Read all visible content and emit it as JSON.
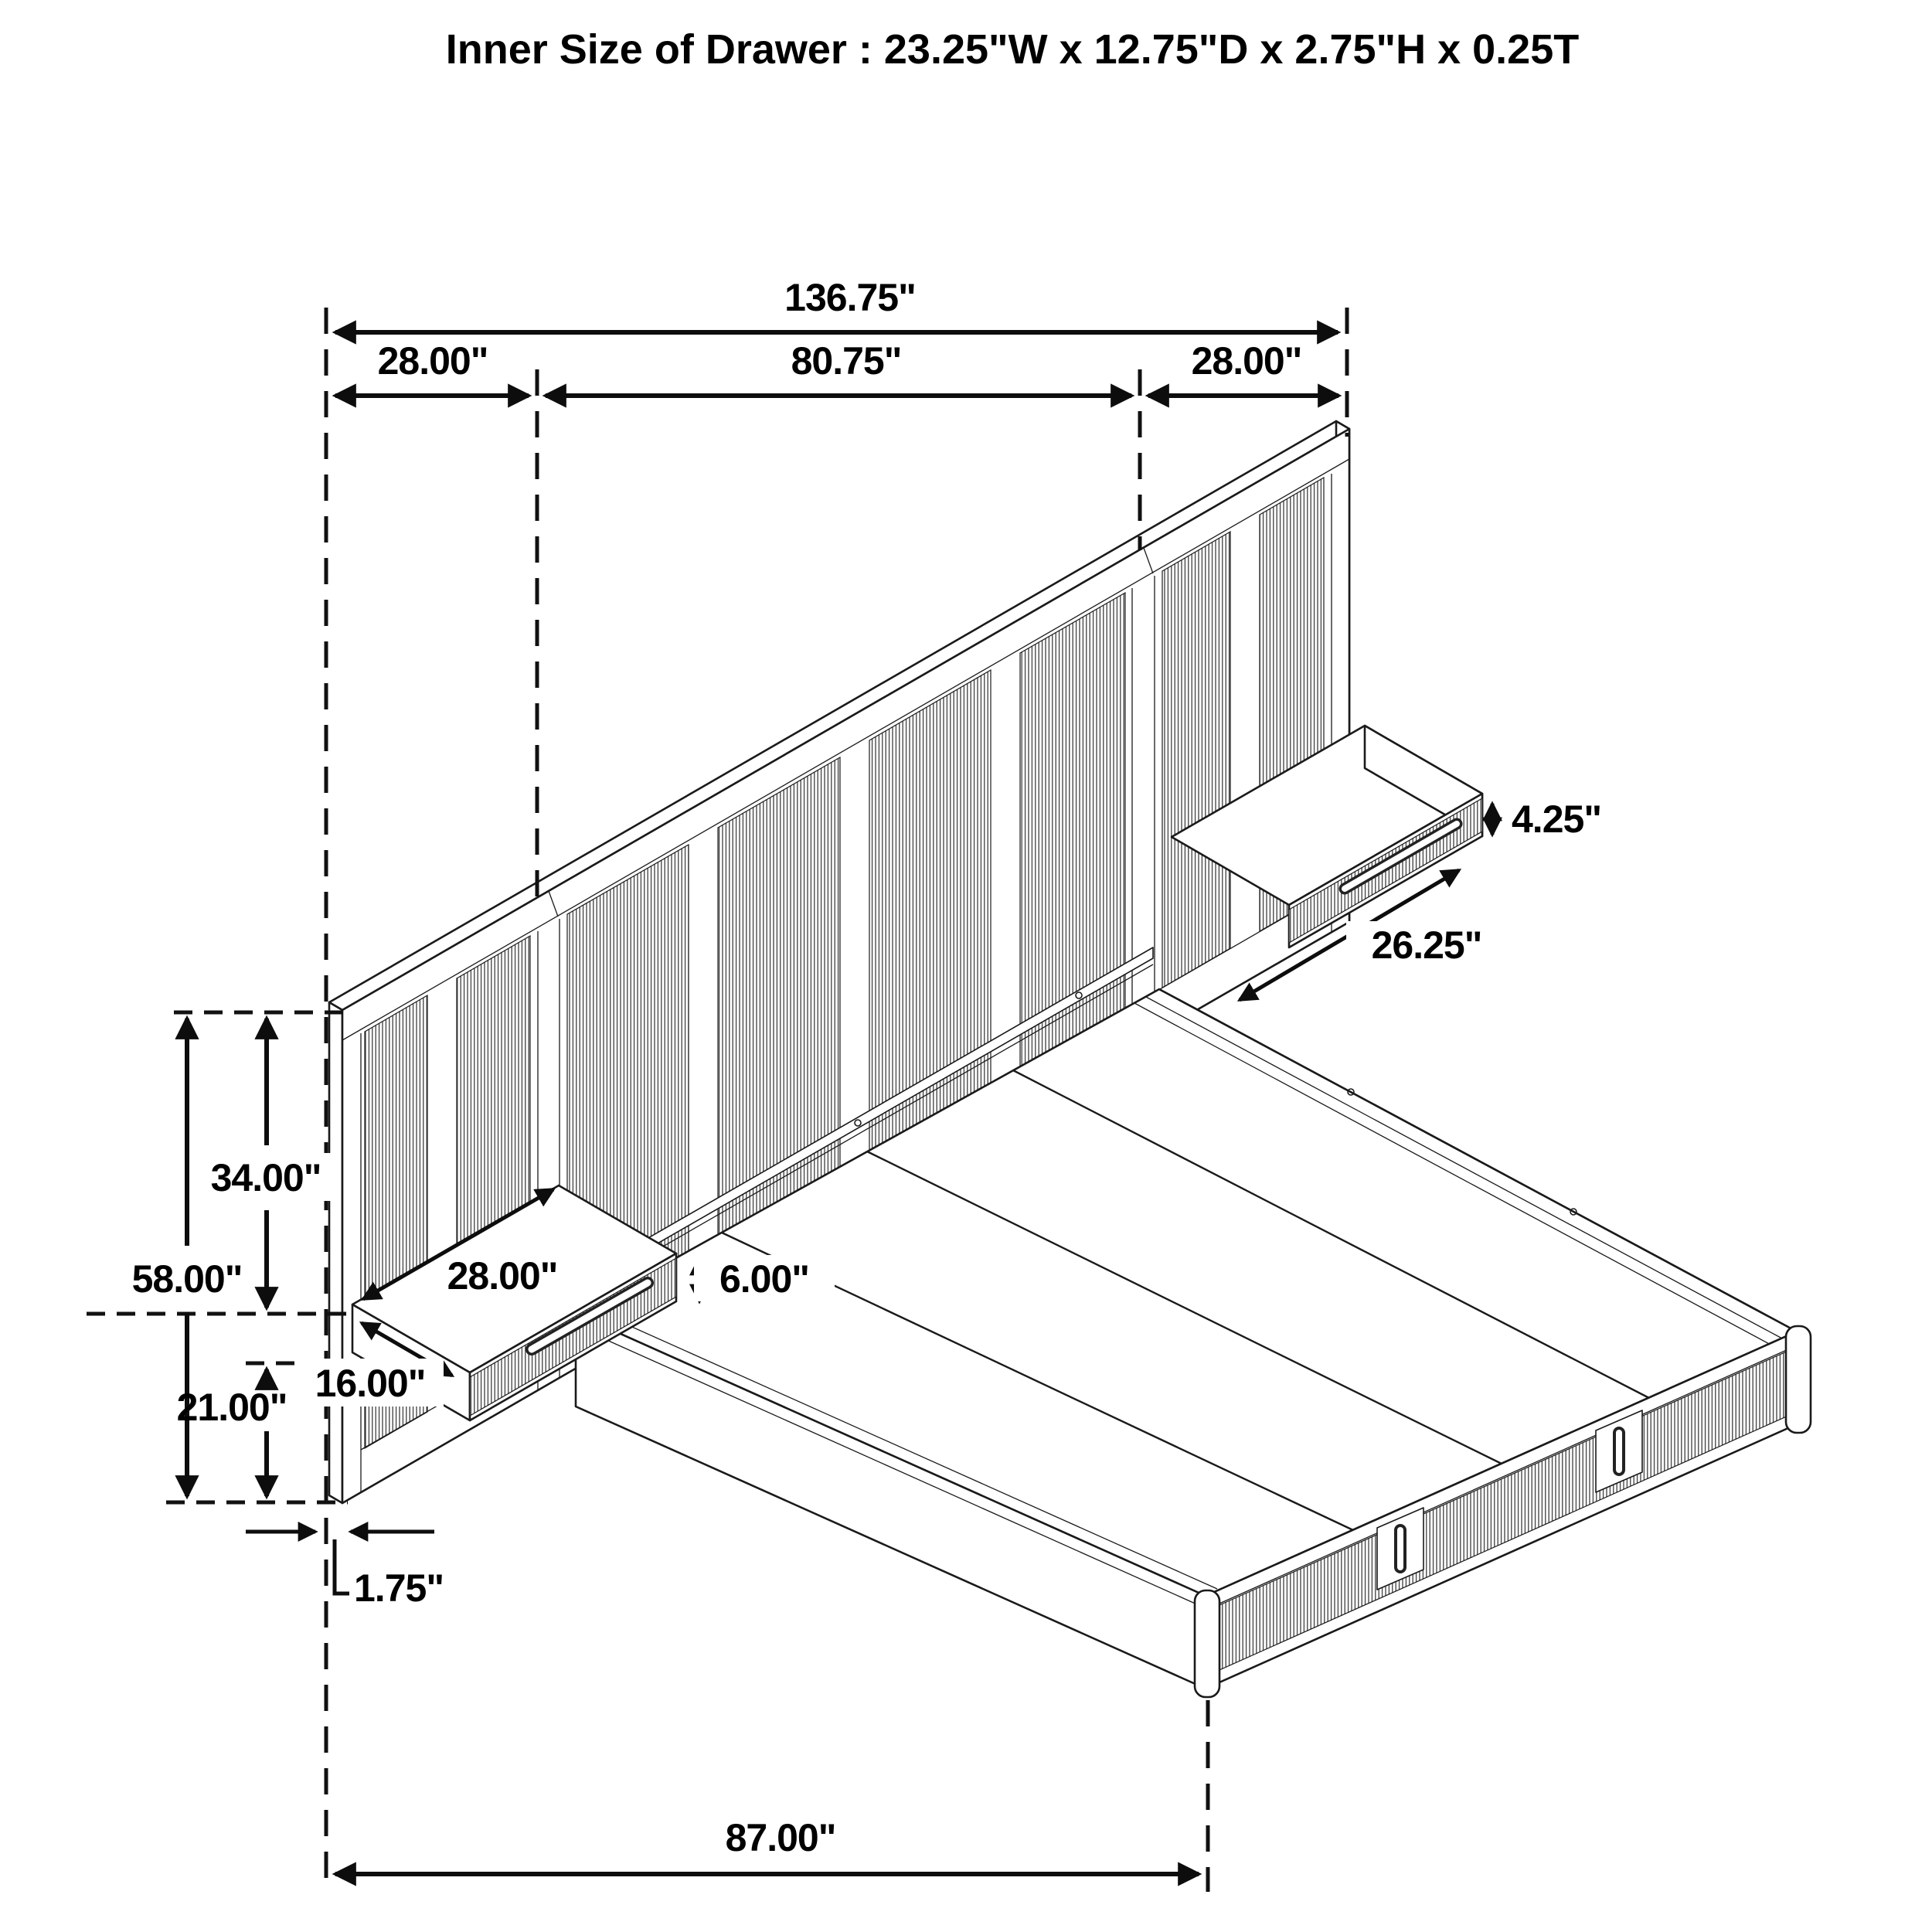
{
  "title": "Inner Size of Drawer : 23.25\"W x 12.75\"D x 2.75\"H x 0.25T",
  "colors": {
    "background": "#ffffff",
    "line": "#1a1a1a",
    "slat_line": "#3d3d3d",
    "text": "#000000",
    "dimension": "#0d0d0d"
  },
  "dimensions": {
    "overall_width": "136.75\"",
    "left_section_width": "28.00\"",
    "center_section_width": "80.75\"",
    "right_section_width": "28.00\"",
    "right_nightstand_height": "4.25\"",
    "right_nightstand_width": "26.25\"",
    "panel_height": "58.00\"",
    "panel_upper_height": "34.00\"",
    "panel_lower_height": "21.00\"",
    "left_nightstand_width": "28.00\"",
    "left_nightstand_height": "6.00\"",
    "left_nightstand_depth": "16.00\"",
    "panel_thickness": "1.75\"",
    "bed_length": "87.00\""
  }
}
